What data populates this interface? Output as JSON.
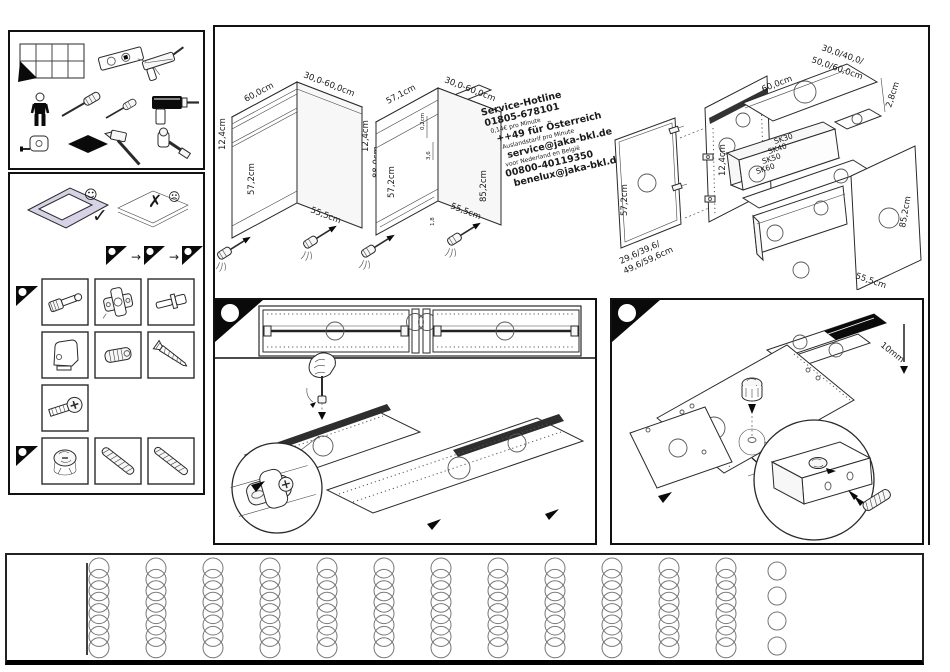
{
  "colors": {
    "ink": "#1a1a1a",
    "paper": "#ffffff",
    "carpet": "#d7d2e6",
    "accent_black": "#000000"
  },
  "tools_panel": {
    "icon_names": [
      "instruction-pages-grid",
      "spirit-level",
      "caulking-gun",
      "person",
      "screwdriver",
      "screwdriver-small",
      "cordless-drill",
      "tape-measure",
      "protective-pad",
      "hammer",
      "socket-wrench"
    ]
  },
  "prep_panel": {
    "ok_check": "✓",
    "ok_face": "☺",
    "bad_cross": "✗",
    "bad_face": "☹",
    "step_arrow": "→",
    "flag_icon_names": [
      "corner-flag",
      "corner-flag",
      "corner-flag"
    ]
  },
  "hardware_panel": {
    "row1": [
      "cam-bolt",
      "hinge",
      "shelf-pin"
    ],
    "row2": [
      "corner-connector",
      "barrel-nut",
      "wood-screw"
    ],
    "row3": [
      "connector-screw"
    ],
    "row4": [
      "cam-lock",
      "threaded-rod",
      "threaded-rod"
    ]
  },
  "overview": {
    "cabinet_closed": {
      "top_width": "60,0cm",
      "top_depth": "30,0-60,0cm",
      "drawer_front": "12,4cm",
      "door": "57,2cm",
      "height": "88,0cm",
      "bottom_depth": "55,5cm"
    },
    "cabinet_open": {
      "top_width": "57,1cm",
      "top_depth": "30,0-60,0cm",
      "drawer_front": "12,4cm",
      "top_gap": "0,2cm",
      "rail": "3,6",
      "door": "57,2cm",
      "height": "85,2cm",
      "bottom_depth": "55,5cm",
      "plinth": "1,8"
    },
    "hotline": {
      "lines": [
        {
          "text": "Service-Hotline"
        },
        {
          "text": "01805-678101"
        },
        {
          "text": "0,14€ pro Minute"
        },
        {
          "text": "++49 für Österreich"
        },
        {
          "text": "Auslandstarif pro Minute"
        },
        {
          "text": "service@jaka-bkl.de"
        },
        {
          "text": "voor Nederland en België"
        },
        {
          "text": "00800-40119350"
        },
        {
          "text": "benelux@jaka-bkl.de"
        }
      ]
    },
    "exploded": {
      "top_width": "60,0cm",
      "top_depth_lines": [
        "30,0/40,0/",
        "50,0/60,0cm"
      ],
      "top_thickness": "2,8cm",
      "side_drawer": "12,4cm",
      "drawer_sizes": [
        "SK30",
        "SK40",
        "SK50",
        "SK60"
      ],
      "door_height": "57,2cm",
      "door_width_lines": [
        "29,6/39,6/",
        "49,6/59,6cm"
      ],
      "side_height": "85,2cm",
      "back_depth": "55,5cm"
    }
  },
  "steps": {
    "step1": {
      "badge_icon": "corner-step-triangle"
    },
    "step2": {
      "badge_icon": "corner-step-triangle",
      "depth_label": "10mm"
    }
  },
  "bottom_strip": {
    "hole_columns": 12,
    "holes_per_column": 8,
    "extra_column_holes": 4
  }
}
